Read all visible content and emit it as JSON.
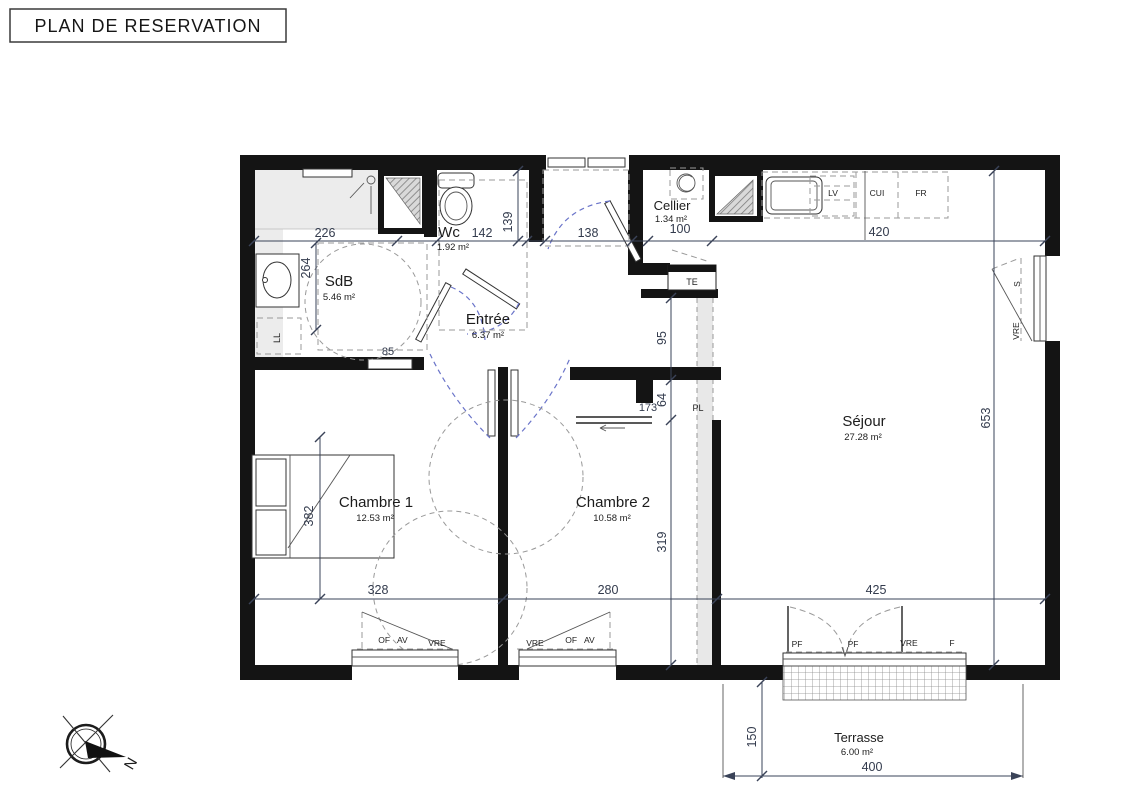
{
  "title": "PLAN DE RESERVATION",
  "colors": {
    "wall": "#141414",
    "dimension_text": "#333b4d",
    "door_arc_blue": "#6a74c9",
    "shade_gray": "#ececec"
  },
  "rooms": {
    "sdb": {
      "name": "SdB",
      "area": "5.46 m²"
    },
    "wc": {
      "name": "Wc",
      "area": "1.92 m²"
    },
    "entree": {
      "name": "Entrée",
      "area": "6.37 m²"
    },
    "cellier": {
      "name": "Cellier",
      "area": "1.34 m²"
    },
    "sejour": {
      "name": "Séjour",
      "area": "27.28 m²"
    },
    "chambre1": {
      "name": "Chambre 1",
      "area": "12.53 m²"
    },
    "chambre2": {
      "name": "Chambre 2",
      "area": "10.58 m²"
    },
    "terrasse": {
      "name": "Terrasse",
      "area": "6.00 m²"
    }
  },
  "dims": {
    "d226": "226",
    "d264": "264",
    "d142": "142",
    "d139": "139",
    "d138": "138",
    "d100": "100",
    "d420": "420",
    "d95": "95",
    "d64": "64",
    "d173": "173",
    "d319": "319",
    "d653": "653",
    "d382": "382",
    "d328": "328",
    "d280": "280",
    "d425": "425",
    "d150": "150",
    "d400": "400",
    "d85": "85"
  },
  "fixtures": {
    "te": "TE",
    "ll": "LL",
    "pl": "PL",
    "lv": "LV",
    "cui": "CUI",
    "fr": "FR"
  },
  "openings": {
    "of_av": "OF AV",
    "vre": "VRE",
    "pf": "PF",
    "f": "F",
    "s": "S"
  },
  "compass": {
    "north": "N"
  }
}
